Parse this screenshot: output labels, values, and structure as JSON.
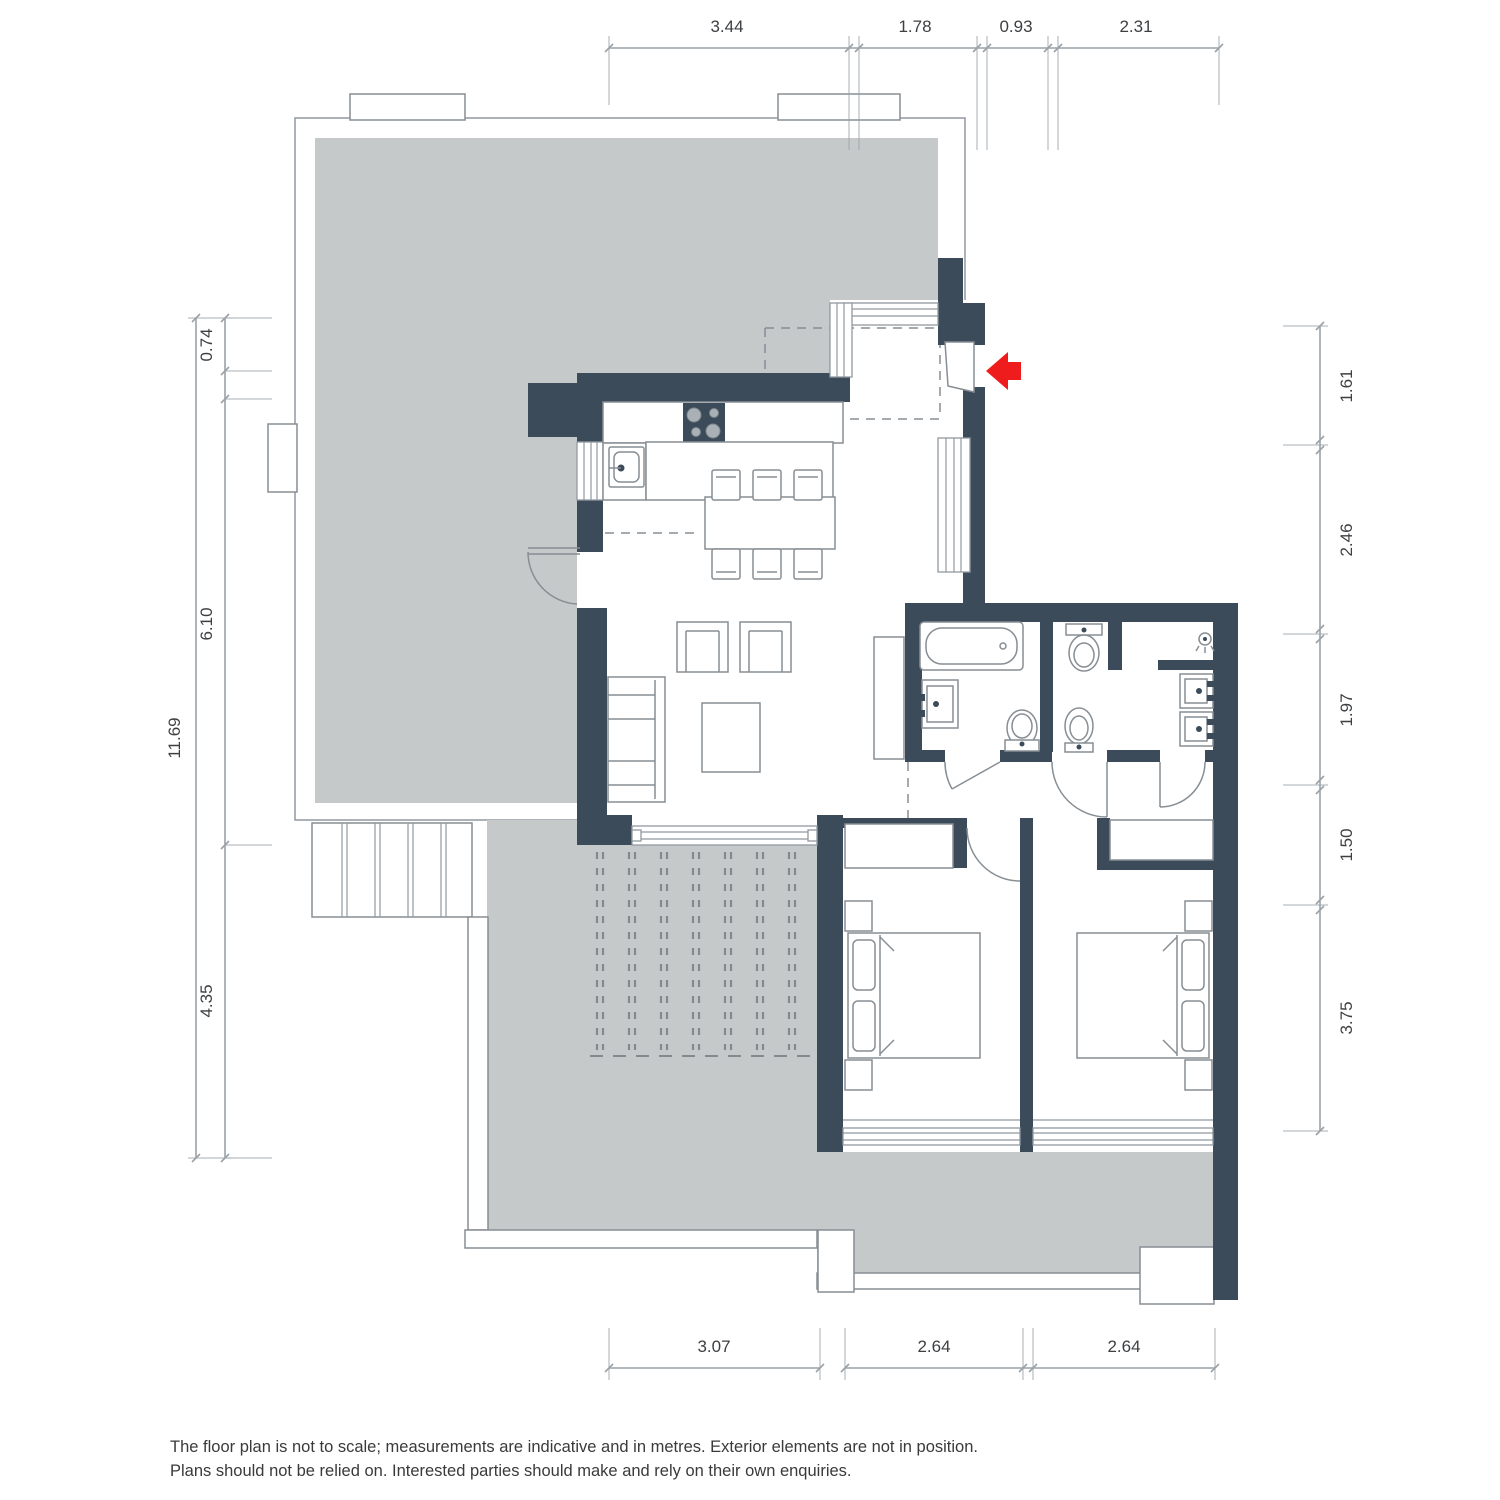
{
  "colors": {
    "wall": "#3c4b5a",
    "terrace": "#c6c9ca",
    "outline": "#9199a0",
    "furnline": "#878e94",
    "dimline": "#9aa1a7",
    "inktext": "#3d4043",
    "arrow": "#ee1c1c"
  },
  "dimensions": {
    "top": [
      "3.44",
      "1.78",
      "0.93",
      "2.31"
    ],
    "left": {
      "overall": "11.69",
      "segments": [
        "0.74",
        "6.10",
        "4.35"
      ]
    },
    "right": [
      "1.61",
      "2.46",
      "1.97",
      "1.50",
      "3.75"
    ],
    "bottom": [
      "3.07",
      "2.64",
      "2.64"
    ]
  },
  "footer": {
    "line1": "The floor plan is not to scale; measurements are indicative and in metres. Exterior elements are not in position.",
    "line2": "Plans should not be relied on. Interested parties should make and rely on their own enquiries."
  }
}
